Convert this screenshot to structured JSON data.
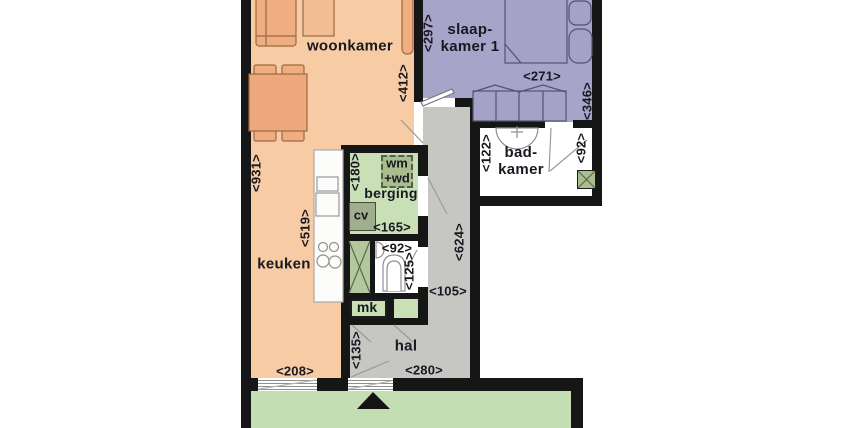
{
  "plan_type": "apartment floor plan",
  "language": "nl",
  "rooms": {
    "woonkamer": {
      "label": "woonkamer"
    },
    "slaapkamer1": {
      "label_line1": "slaap-",
      "label_line2": "kamer 1"
    },
    "badkamer": {
      "label_line1": "bad-",
      "label_line2": "kamer"
    },
    "berging": {
      "label": "berging"
    },
    "keuken": {
      "label": "keuken"
    },
    "hal": {
      "label": "hal"
    }
  },
  "fixtures": {
    "washer_dryer_line1": "wm",
    "washer_dryer_line2": "+wd",
    "boiler": "cv",
    "meter_cupboard": "mk"
  },
  "dimensions_cm": {
    "living_left_height": "<931>",
    "kitchen_counter_height": "<519>",
    "kitchen_bottom_width": "<208>",
    "living_right_wall": "<412>",
    "bedroom_left_height": "<297>",
    "bedroom_wardrobe_width": "<271>",
    "bedroom_right_height": "<346>",
    "bathroom_left_height": "<122>",
    "bathroom_door": "<92>",
    "storage_left_height": "<180>",
    "storage_bottom_width": "<165>",
    "toilet_width": "<92>",
    "toilet_height": "<125>",
    "hall_corridor_length": "<624>",
    "hall_corridor_width": "<105>",
    "hall_bottom_height": "<135>",
    "hall_bottom_width": "<280>"
  },
  "colors": {
    "wall": "#161616",
    "floor_living_kitchen": "#f7cba4",
    "floor_bedroom": "#a7a4c9",
    "floor_hall": "#c6c6c2",
    "floor_storage": "#c9dfb5",
    "floor_outdoor": "#c3deb2",
    "fixture_green_dark": "#a9bd8f",
    "furniture_living": "#efad80",
    "furniture_bedroom": "#a5a2c8",
    "text": "#181820",
    "room_white": "#ffffff"
  },
  "icons": {
    "entrance_marker": "black triangle pointing up at front door"
  }
}
